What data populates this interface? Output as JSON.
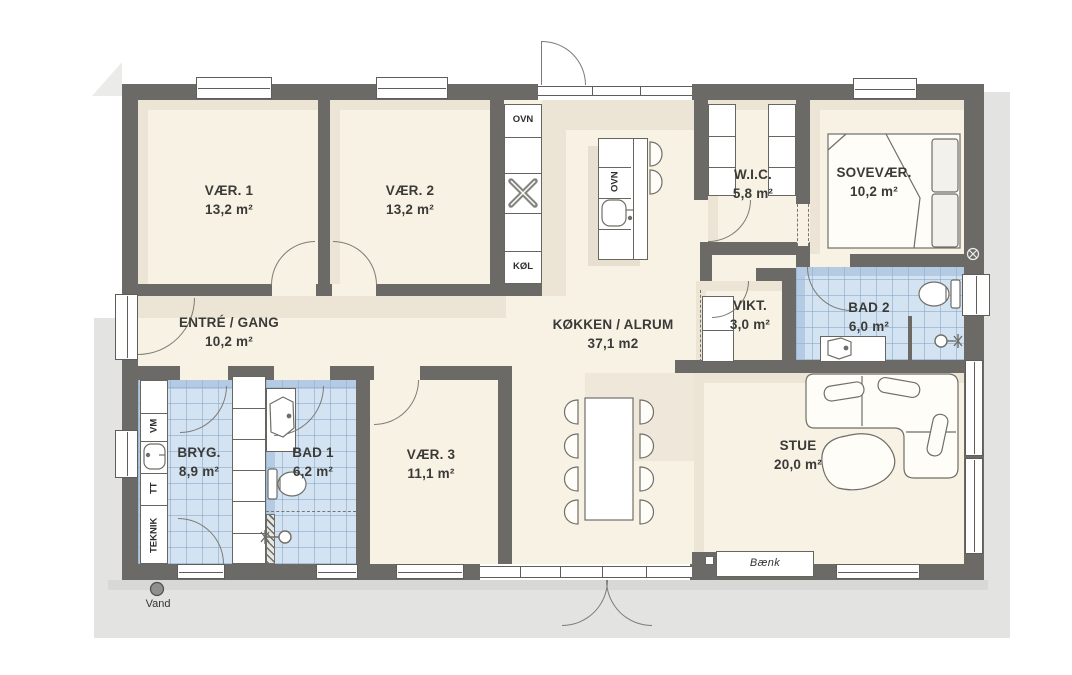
{
  "rooms": [
    {
      "name": "VÆR. 1",
      "area": "13,2 m²"
    },
    {
      "name": "VÆR. 2",
      "area": "13,2 m²"
    },
    {
      "name": "ENTRÉ / GANG",
      "area": "10,2 m²"
    },
    {
      "name": "KØKKEN / ALRUM",
      "area": "37,1 m2"
    },
    {
      "name": "W.I.C.",
      "area": "5,8 m²"
    },
    {
      "name": "SOVEVÆR.",
      "area": "10,2 m²"
    },
    {
      "name": "VIKT.",
      "area": "3,0 m²"
    },
    {
      "name": "BAD 2",
      "area": "6,0 m²"
    },
    {
      "name": "BRYG.",
      "area": "8,9 m²"
    },
    {
      "name": "BAD 1",
      "area": "6,2 m²"
    },
    {
      "name": "VÆR. 3",
      "area": "11,1 m²"
    },
    {
      "name": "STUE",
      "area": "20,0 m²"
    }
  ],
  "appliances": {
    "oven": "OVN",
    "fridge": "KØL",
    "island_oven": "OVN",
    "washing_machine": "VM",
    "tumble_dryer": "TT",
    "technical": "TEKNIK"
  },
  "annotations": {
    "water": "Vand",
    "bench": "Bænk"
  },
  "icons": [
    "hob-icon",
    "sink-icon",
    "toilet-icon",
    "shower-icon",
    "ventilation-icon",
    "water-point-icon"
  ],
  "colors": {
    "wall": "#6b6a67",
    "floor": "#f8f2e4",
    "floor_shadow": "#ece4d5",
    "tile": "#d4e3f1",
    "outside": "#e3e3e2",
    "furniture_line": "#6f6e68"
  }
}
